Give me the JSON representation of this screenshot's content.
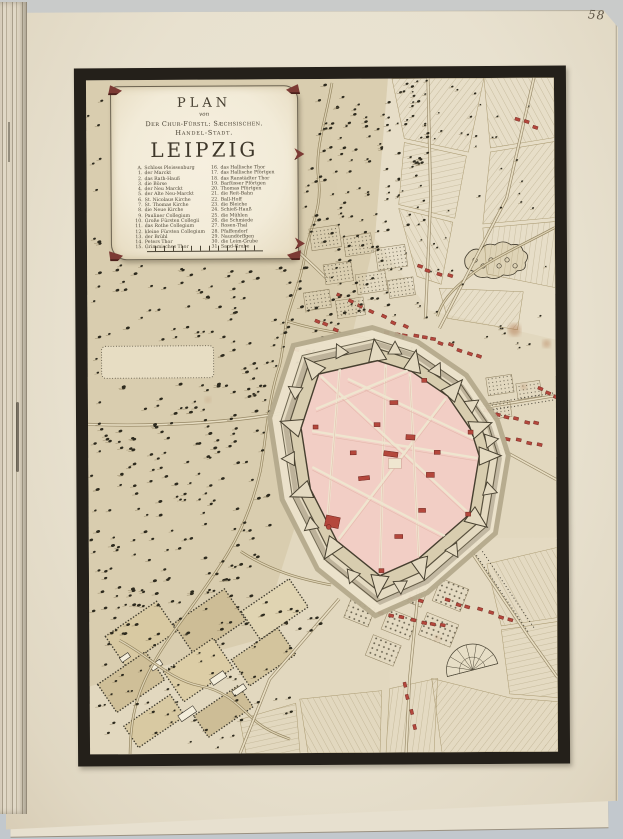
{
  "page": {
    "number": "58"
  },
  "cartouche": {
    "title_line1": "PLAN",
    "title_line2": "von",
    "title_line3": "Der Chur-Fürstl: Sæchsischen.",
    "title_line4": "Handel-Stadt.",
    "title_line5": "LEIPZIG",
    "legend_left": [
      {
        "k": "A.",
        "label": "Schloss Pleissenburg"
      },
      {
        "k": "1.",
        "label": "der Marckt"
      },
      {
        "k": "2.",
        "label": "das Rath-Hauß"
      },
      {
        "k": "3.",
        "label": "die Börse"
      },
      {
        "k": "4.",
        "label": "der Neu Marckt"
      },
      {
        "k": "5.",
        "label": "der Alte Neu-Marckt"
      },
      {
        "k": "6.",
        "label": "St. Nicolaus Kirche"
      },
      {
        "k": "7.",
        "label": "St. Thomas Kirche"
      },
      {
        "k": "8.",
        "label": "die Neue Kirche"
      },
      {
        "k": "9.",
        "label": "Pauliner Collegium"
      },
      {
        "k": "10.",
        "label": "Große Fürsten Collegii"
      },
      {
        "k": "11.",
        "label": "das Rothe Collegium"
      },
      {
        "k": "12.",
        "label": "kleine Fürsten Collegium"
      },
      {
        "k": "13.",
        "label": "der Brühl"
      },
      {
        "k": "14.",
        "label": "Peters Thor"
      },
      {
        "k": "15.",
        "label": "Grimmisches Thor"
      }
    ],
    "legend_right": [
      {
        "k": "16.",
        "label": "das Hallische Thor"
      },
      {
        "k": "17.",
        "label": "das Hallische Pförtgen"
      },
      {
        "k": "18.",
        "label": "das Ranstädter Thor"
      },
      {
        "k": "19.",
        "label": "Barfüsser Pförtgen"
      },
      {
        "k": "20.",
        "label": "Thomas Pförtgen"
      },
      {
        "k": "21.",
        "label": "die Reit-Bahn"
      },
      {
        "k": "22.",
        "label": "Ball-Hoff"
      },
      {
        "k": "23.",
        "label": "die Bleiche"
      },
      {
        "k": "24.",
        "label": "Schieß-Hauß"
      },
      {
        "k": "25.",
        "label": "die Mühlen"
      },
      {
        "k": "26.",
        "label": "die Schmiede"
      },
      {
        "k": "27.",
        "label": "Rosen-Thal"
      },
      {
        "k": "28.",
        "label": "Pfaffendorf"
      },
      {
        "k": "29.",
        "label": "Naundörffgen"
      },
      {
        "k": "30.",
        "label": "die Leim-Grube"
      },
      {
        "k": "31.",
        "label": "Sand-Grube"
      }
    ]
  },
  "colors": {
    "background_gray": "#c7cacb",
    "page_cream": "#e9e2d1",
    "map_paper": "#e2d8bf",
    "west_tan": "#d2c4a2",
    "frame_black": "#24201a",
    "city_pink": "#f2cec5",
    "building_red": "#b4473c",
    "accent_maroon": "#7c3a34",
    "line_sepia": "#8a7a54",
    "tree_dark": "#2d2a1e",
    "fort_line": "#463f2f"
  }
}
